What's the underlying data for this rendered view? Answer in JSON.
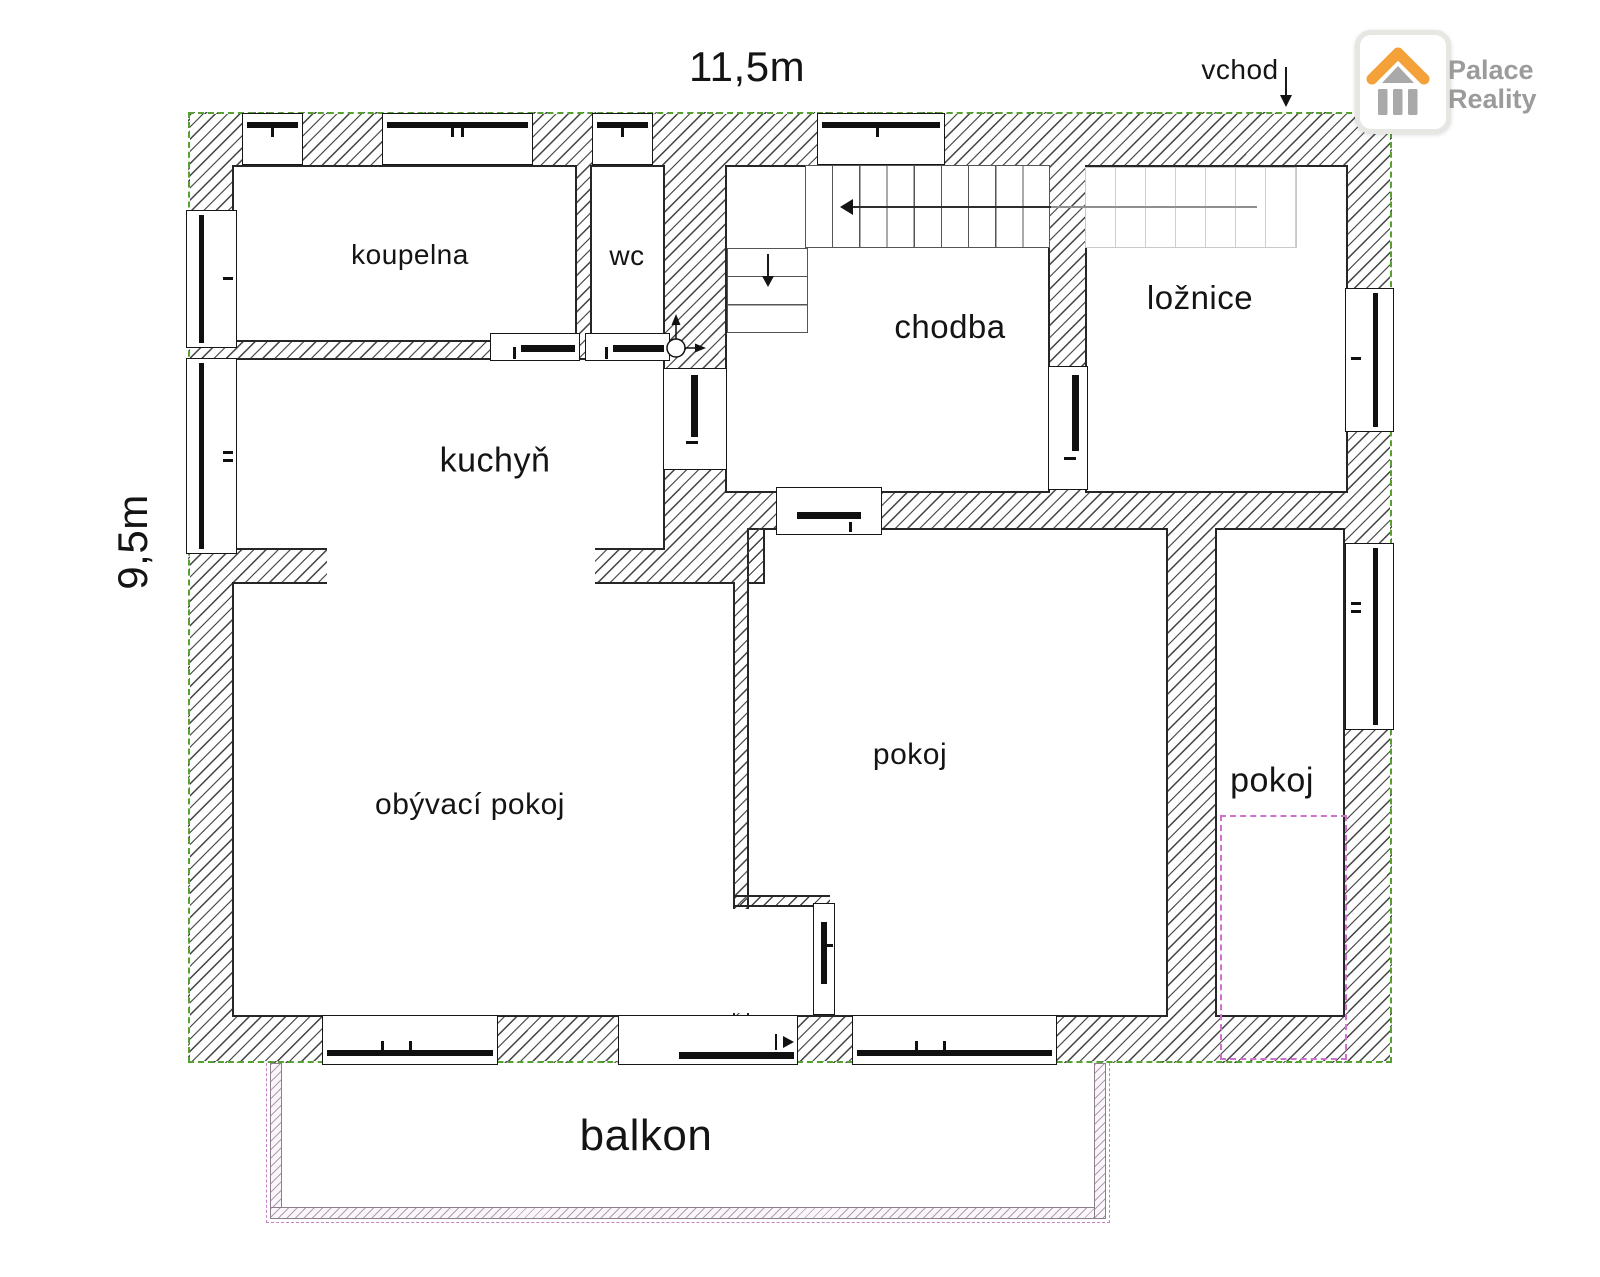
{
  "plan": {
    "dimensions": {
      "width_label": "11,5m",
      "height_label": "9,5m"
    },
    "entrance_label": "vchod",
    "rooms": [
      {
        "id": "koupelna",
        "label": "koupelna"
      },
      {
        "id": "wc",
        "label": "wc"
      },
      {
        "id": "chodba",
        "label": "chodba"
      },
      {
        "id": "loznice",
        "label": "ložnice"
      },
      {
        "id": "kuchyn",
        "label": "kuchyň"
      },
      {
        "id": "obyvaci_pokoj",
        "label": "obývací pokoj"
      },
      {
        "id": "pokoj_stredni",
        "label": "pokoj"
      },
      {
        "id": "pokoj_pravy",
        "label": "pokoj"
      },
      {
        "id": "balkon",
        "label": "balkon"
      }
    ]
  },
  "logo": {
    "line1": "Palace",
    "line2": "Reality"
  },
  "colors": {
    "wall_line": "#262626",
    "hatch": "#3f3f3f",
    "outline_green": "#55a22e",
    "balcony_pink": "#c77fc7",
    "planned_pink": "#ce72ce",
    "logo_orange": "#f4a139",
    "logo_gray": "#9b9b9b"
  }
}
